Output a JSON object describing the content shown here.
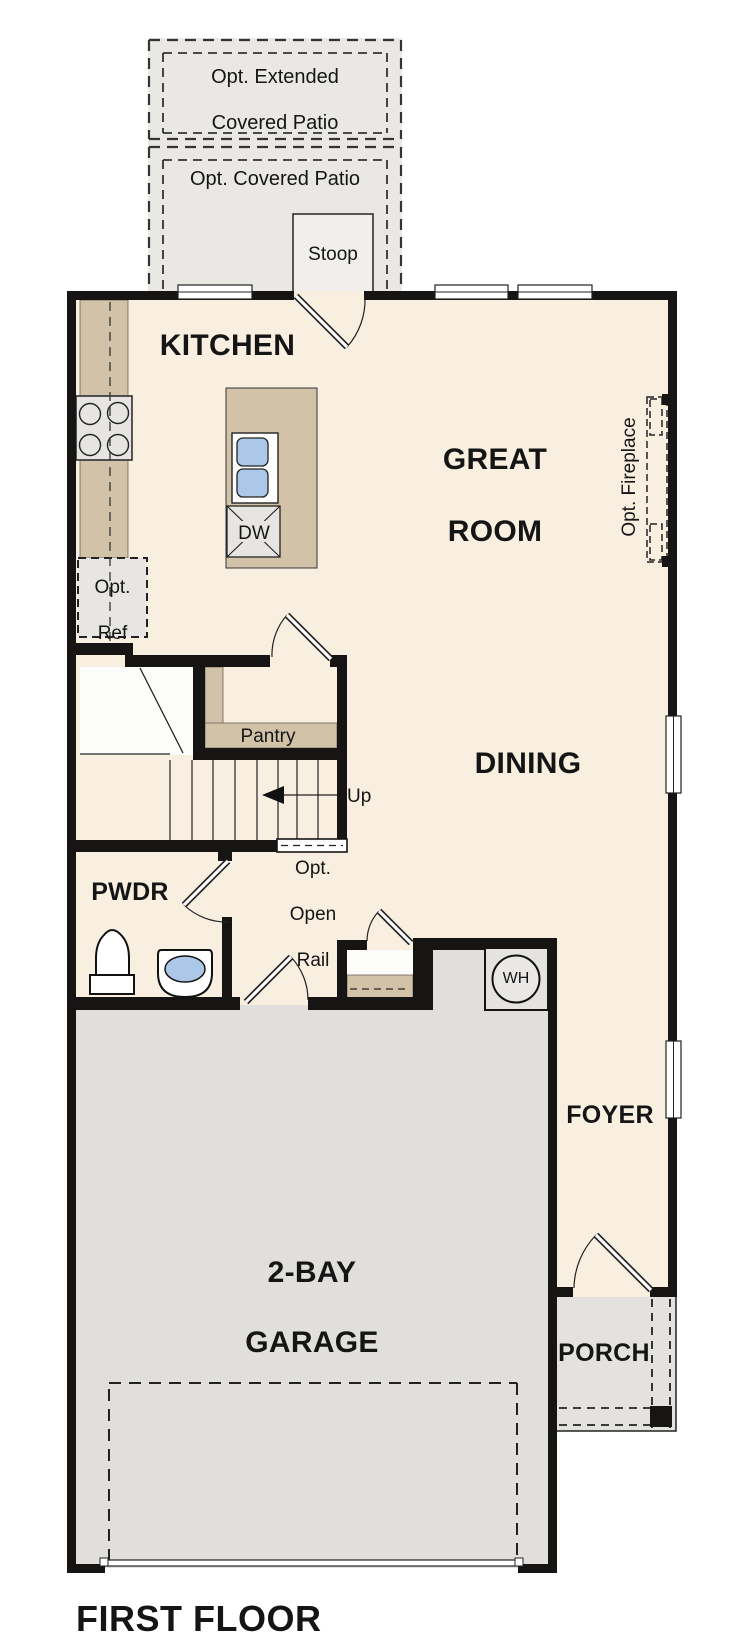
{
  "plan_title": "FIRST FLOOR",
  "colors": {
    "wall": "#161514",
    "interior_floor": "#f8efe0",
    "garage_floor": "#e0dfdc",
    "patio_gray": "#e9e8e5",
    "counter_tan": "#d2c3a8",
    "appliance_gray": "#e6e5e2",
    "sink_blue": "#abc8e8"
  },
  "labels": {
    "patio_extended": {
      "line1": "Opt. Extended",
      "line2": "Covered Patio"
    },
    "patio_covered": "Opt. Covered Patio",
    "stoop": "Stoop",
    "kitchen": "KITCHEN",
    "great_room": {
      "line1": "GREAT",
      "line2": "ROOM"
    },
    "fireplace": "Opt. Fireplace",
    "dishwasher": "DW",
    "fridge": {
      "line1": "Opt.",
      "line2": "Ref"
    },
    "pantry": "Pantry",
    "stairs_direction": "Up",
    "dining": "DINING",
    "open_rail": {
      "line1": "Opt.",
      "line2": "Open",
      "line3": "Rail"
    },
    "powder_room": "PWDR",
    "water_heater": "WH",
    "foyer": "FOYER",
    "garage": {
      "line1": "2-BAY",
      "line2": "GARAGE"
    },
    "porch": "PORCH"
  }
}
